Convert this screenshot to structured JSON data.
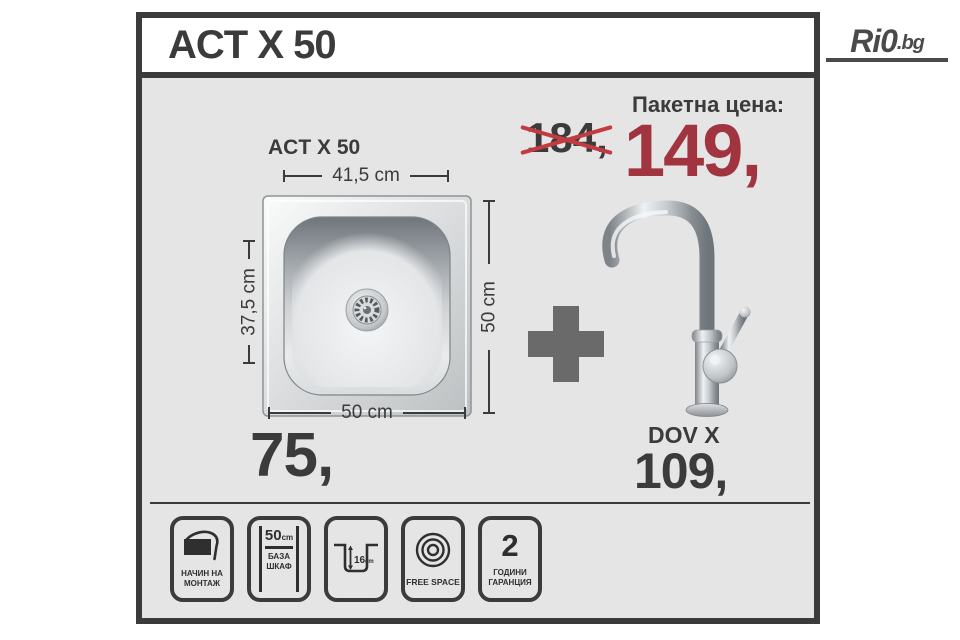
{
  "logo": {
    "text_main": "Ri0",
    "text_tld": ".bg"
  },
  "header": {
    "title": "ACT X 50"
  },
  "package": {
    "label": "Пакетна цена:",
    "old_price": "184,",
    "new_price": "149,"
  },
  "sink": {
    "model": "ACT X 50",
    "dim_top": "41,5 cm",
    "dim_left": "37,5 cm",
    "dim_right": "50 cm",
    "dim_bottom": "50 cm",
    "price": "75,"
  },
  "faucet": {
    "model": "DOV X",
    "price": "109,"
  },
  "badges": [
    {
      "line1": "НАЧИН НА",
      "line2": "МОНТАЖ"
    },
    {
      "value": "50",
      "unit": "cm",
      "line1": "БАЗА",
      "line2": "ШКАФ"
    },
    {
      "value": "16",
      "unit": "cm"
    },
    {
      "line1": "FREE SPACE"
    },
    {
      "value": "2",
      "line1": "ГОДИНИ",
      "line2": "ГАРАНЦИЯ"
    }
  ],
  "colors": {
    "accent_red": "#a03540",
    "cross_red": "#c23b3f",
    "frame_dark": "#3b3b3b",
    "body_bg": "#e5e5e6",
    "plus_gray": "#6a6a6a",
    "logo_gray": "#4a4a4a"
  }
}
